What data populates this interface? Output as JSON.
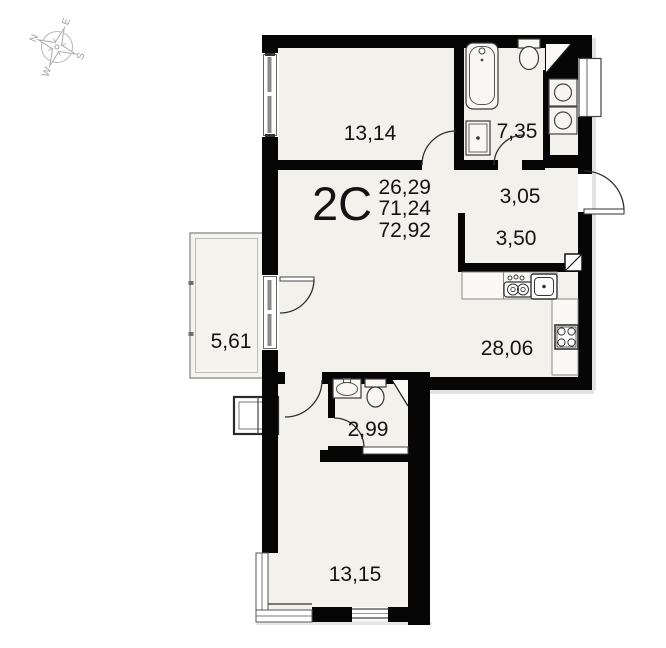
{
  "document": {
    "type": "apartment-floor-plan",
    "background": "#ffffff"
  },
  "unit": {
    "code": "2С",
    "areas": [
      "26,29",
      "71,24",
      "72,92"
    ]
  },
  "rooms": [
    {
      "id": "room-top",
      "label": "13,14"
    },
    {
      "id": "bathroom-top",
      "label": "7,35"
    },
    {
      "id": "hall",
      "label": "3,05"
    },
    {
      "id": "closet",
      "label": "3,50"
    },
    {
      "id": "balcony",
      "label": "5,61"
    },
    {
      "id": "kitchen-living",
      "label": "28,06"
    },
    {
      "id": "wc-small",
      "label": "2,99"
    },
    {
      "id": "room-bottom",
      "label": "13,15"
    }
  ],
  "compass": {
    "north": "N",
    "east": "E",
    "south": "S",
    "west": "W"
  },
  "icons": [
    "compass-rose",
    "bathtub",
    "toilet",
    "sink",
    "washing-machine",
    "dryer",
    "stove-2-burner",
    "kitchen-sink",
    "stove-4-burner",
    "air-duct",
    "shaft-diagonal"
  ],
  "colors": {
    "wall": "#060606",
    "floor": "#f2f1ec",
    "line": "#333333",
    "counter": "#faf9f5",
    "balcony_line": "#909090",
    "compass": "#b4b4b4",
    "text": "#131313"
  }
}
